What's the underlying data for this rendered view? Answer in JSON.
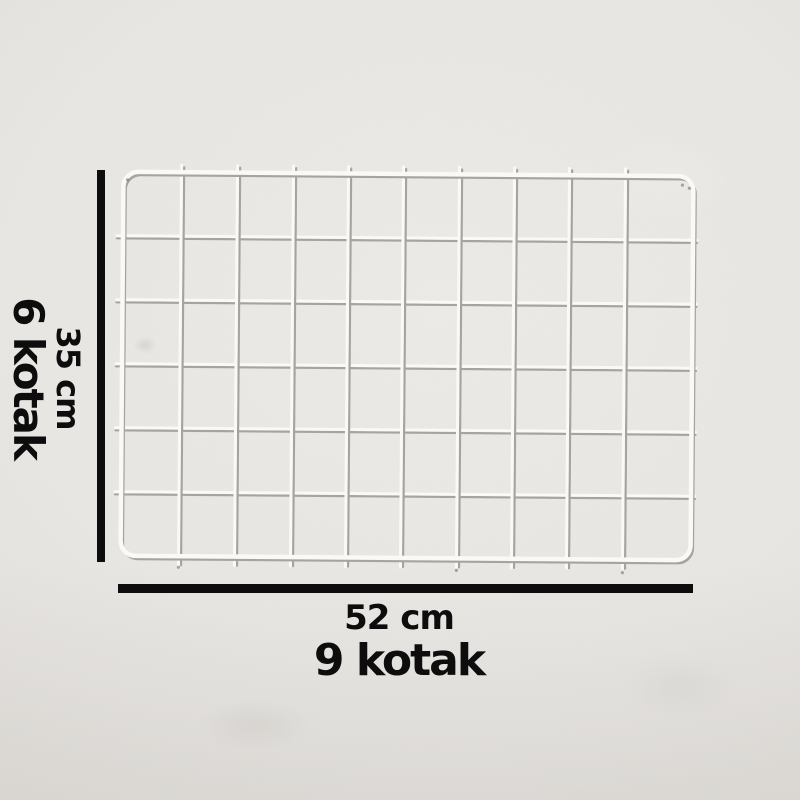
{
  "labels": {
    "left": {
      "length": "35 cm",
      "count": "6 kotak"
    },
    "bottom": {
      "length": "52 cm",
      "count": "9 kotak"
    }
  },
  "colors": {
    "wall": "#e9e7e4",
    "dimension_line": "#0d0d0d",
    "text": "#0d0d0d",
    "wire": "#faf9f6",
    "wire_shadow": "#a7a49e"
  },
  "panel": {
    "frame": {
      "x1": 122,
      "y1": 174,
      "x2": 692,
      "y2": 558,
      "radius": 15,
      "stroke": 4.5
    },
    "verticals": [
      180,
      236,
      292,
      347,
      402,
      458,
      513,
      568,
      624
    ],
    "vertical_extent": [
      167,
      567
    ],
    "horizontals": [
      238,
      302,
      366,
      430,
      494
    ],
    "horizontal_extent": [
      116,
      696
    ],
    "wire_width": 3,
    "shadow_width": 2.2,
    "shadow_offset": 2.6,
    "specks": [
      [
        126,
        182
      ],
      [
        681,
        183
      ],
      [
        180,
        569
      ],
      [
        458,
        570
      ],
      [
        624,
        571
      ],
      [
        688,
        186
      ]
    ]
  }
}
